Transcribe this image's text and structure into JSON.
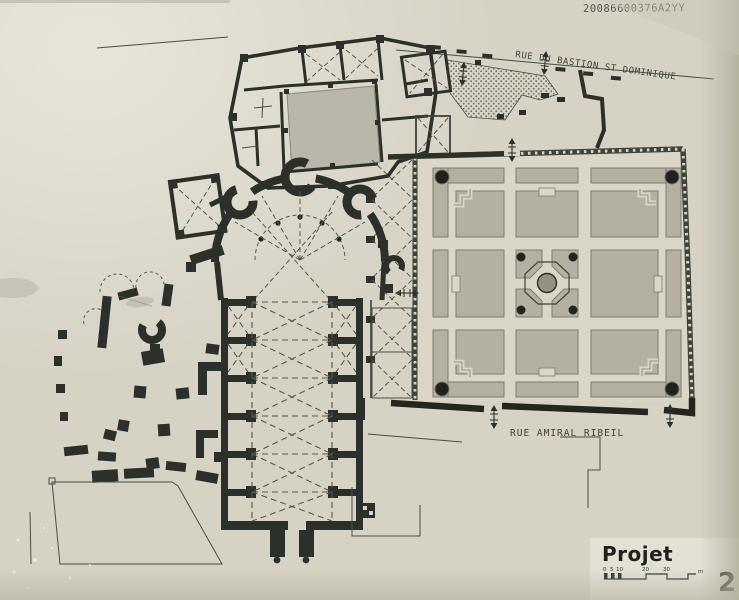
{
  "annotations": {
    "reference_number": "20086600376A2YY"
  },
  "streets": {
    "bastion_st_dominique": "RUE DU BASTION ST DOMINIQUE",
    "amiral_ribeil": "RUE AMIRAL RIBEIL"
  },
  "titleblock": {
    "project_label": "Projet",
    "page_number": "2",
    "scale": {
      "ticks": [
        "0",
        "5",
        "10",
        "20",
        "30"
      ],
      "unit": "m"
    }
  },
  "colors": {
    "paper": "#d6d3c5",
    "ink": "#2c302a",
    "garden_bed": "#b4b1a2",
    "courtyard": "#b9b7aa"
  }
}
